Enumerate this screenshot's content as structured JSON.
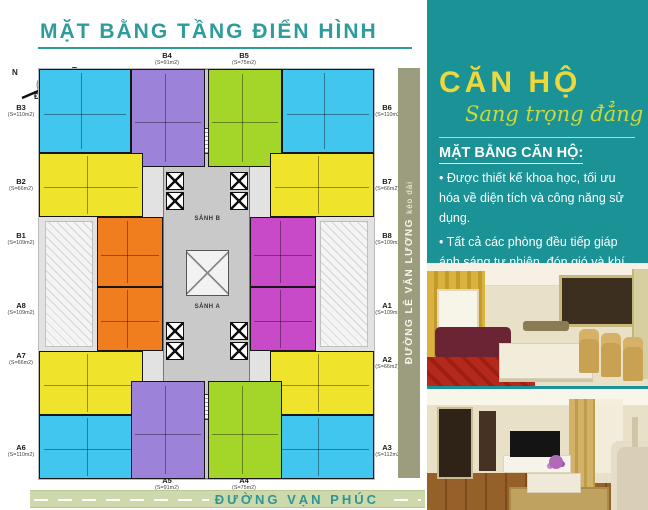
{
  "page_title": "MẶT BẰNG TẦNG ĐIỂN HÌNH",
  "compass": {
    "top_left": "N",
    "top_right": "T",
    "bottom_left": "Đ",
    "bottom_right": "B"
  },
  "floor_plan": {
    "lobby_top": "SẢNH B",
    "lobby_bottom": "SẢNH A",
    "street_bottom": "ĐƯỜNG VẠN PHÚC",
    "street_right": "ĐƯỜNG LÊ VĂN LƯƠNG",
    "street_right_suffix": "kéo dài",
    "units": [
      {
        "id": "B3",
        "area": "(S=110m2)",
        "color": "#41c6f0"
      },
      {
        "id": "B4",
        "area": "(S=91m2)",
        "color": "#9c82d8"
      },
      {
        "id": "B5",
        "area": "(S=75m2)",
        "color": "#a4d529"
      },
      {
        "id": "B6",
        "area": "(S=110m2)",
        "color": "#41c6f0"
      },
      {
        "id": "B2",
        "area": "(S=66m2)",
        "color": "#efe32b"
      },
      {
        "id": "B7",
        "area": "(S=66m2)",
        "color": "#efe32b"
      },
      {
        "id": "B1",
        "area": "(S=109m2)",
        "color": "#f07d1e"
      },
      {
        "id": "B8",
        "area": "(S=109m2)",
        "color": "#c94ac9"
      },
      {
        "id": "A8",
        "area": "(S=109m2)",
        "color": "#f07d1e"
      },
      {
        "id": "A1",
        "area": "(S=109m2)",
        "color": "#c94ac9"
      },
      {
        "id": "A7",
        "area": "(S=66m2)",
        "color": "#efe32b"
      },
      {
        "id": "A2",
        "area": "(S=66m2)",
        "color": "#efe32b"
      },
      {
        "id": "A6",
        "area": "(S=110m2)",
        "color": "#41c6f0"
      },
      {
        "id": "A3",
        "area": "(S=112m2)",
        "color": "#41c6f0"
      },
      {
        "id": "A5",
        "area": "(S=91m2)",
        "color": "#9c82d8"
      },
      {
        "id": "A4",
        "area": "(S=75m2)",
        "color": "#a4d529"
      }
    ]
  },
  "sidebar": {
    "heading": "CĂN HỘ",
    "tagline": "Sang trọng đẳng cấp",
    "section_title": "MẶT BẰNG CĂN HỘ:",
    "bullets": [
      "• Được thiết kế khoa học, tối ưu hóa về diện tích và công năng sử dụng.",
      "• Tất cả các phòng đều tiếp giáp ánh sáng tự nhiên, đón gió và khí trời."
    ],
    "accent_teal": "#1a9296",
    "accent_yellow": "#ead83c"
  }
}
